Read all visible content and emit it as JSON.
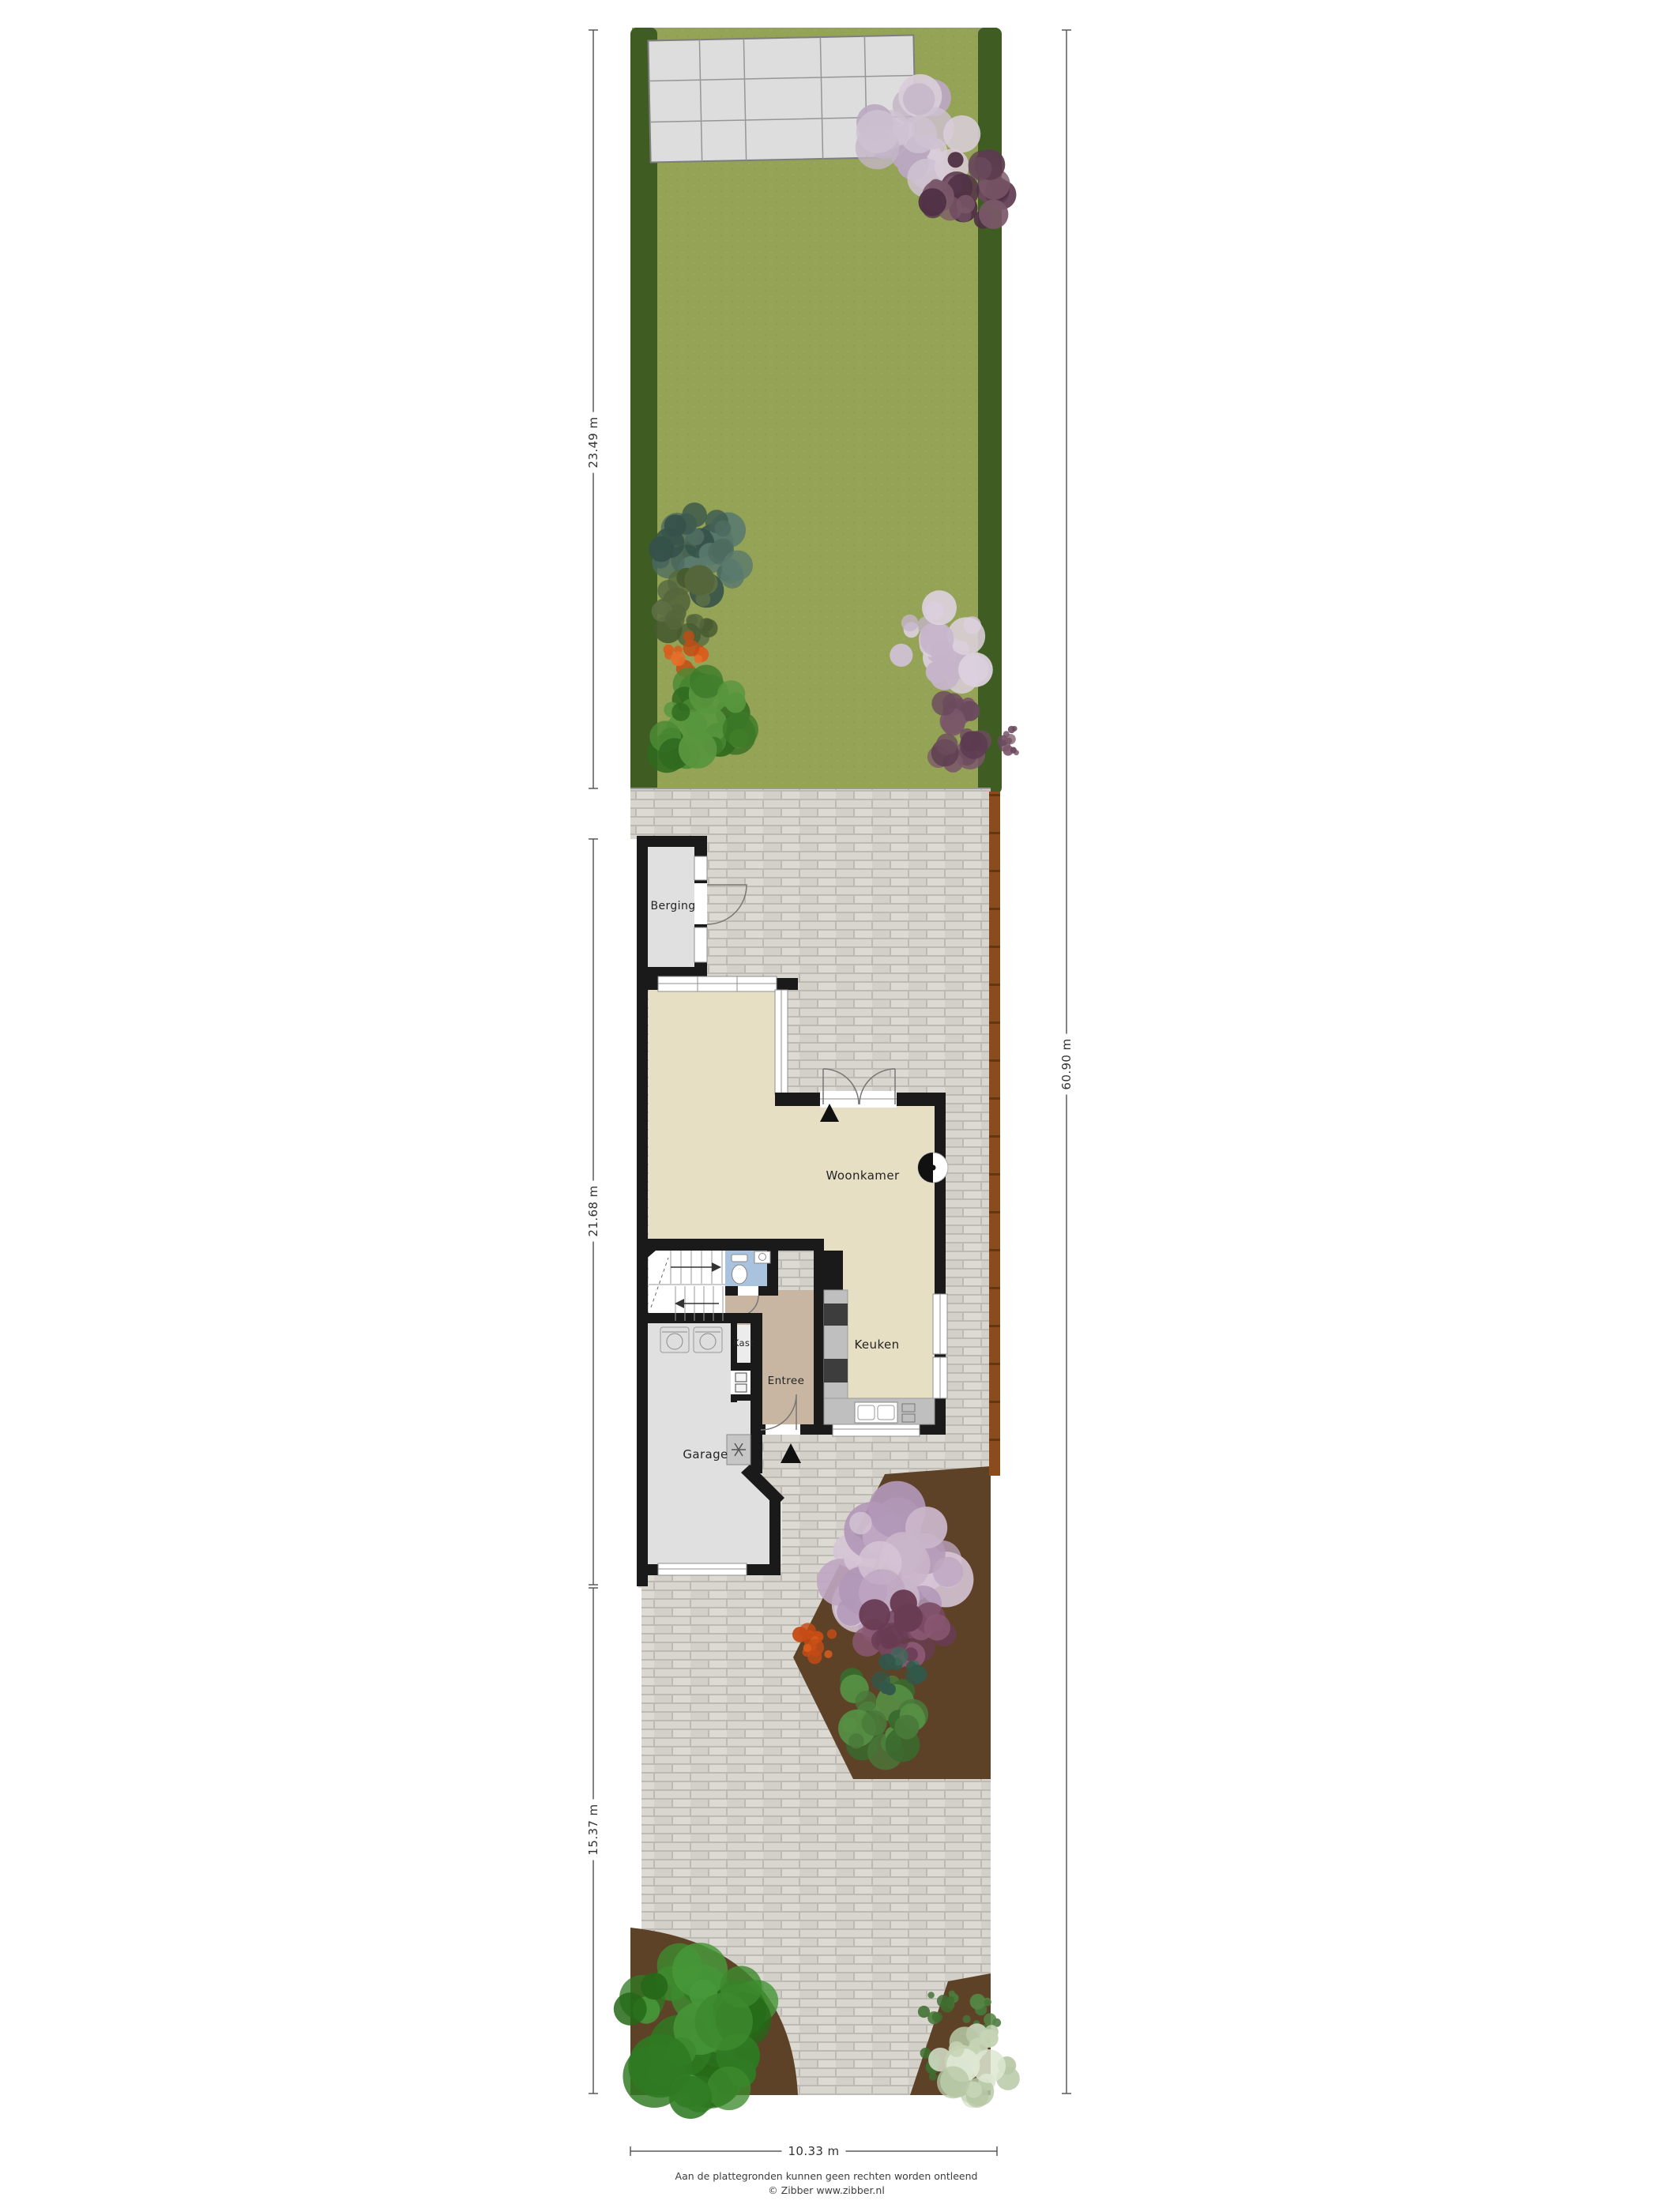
{
  "rooms": {
    "berging": "Berging",
    "woonkamer": "Woonkamer",
    "keuken": "Keuken",
    "entree": "Entree",
    "kast": "Kast",
    "garage": "Garage"
  },
  "dimensions": {
    "garden_depth": "23.49 m",
    "house_depth": "21.68 m",
    "driveway_depth": "15.37 m",
    "total_depth": "60.90 m",
    "plot_width": "10.33 m"
  },
  "footer": {
    "disclaimer": "Aan de plattegronden kunnen geen rechten worden ontleend",
    "credit": "© Zibber www.zibber.nl"
  },
  "icons": {
    "entrance_arrow": "▲",
    "fireplace": "◐"
  },
  "colors": {
    "lawn": "#94a355",
    "hedge": "#3f5d22",
    "plate": "#dcdddc",
    "brick": "#d3d1c9",
    "soil": "#5d4227",
    "fence": "#8a4c1d",
    "wall": "#1a1a1a",
    "floor_living": "#e7dfc3",
    "floor_entree": "#c9b6a2",
    "floor_toilet": "#a9c3df",
    "floor_garage": "#e0e0e0",
    "counter": "#bfbfbf",
    "appliance": "#3d3d3d"
  }
}
